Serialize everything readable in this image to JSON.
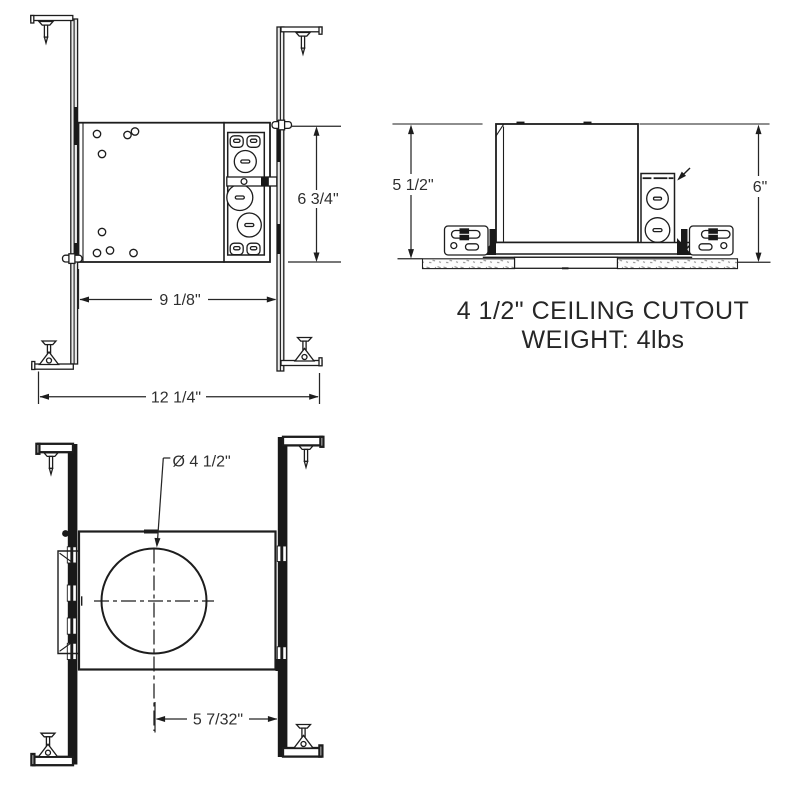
{
  "colors": {
    "ink": "#1d1d1d",
    "label_text": "#2e2e2e"
  },
  "dimensions": {
    "front_height": "6 3/4\"",
    "front_width": "9 1/8\"",
    "front_overall_width": "12 1/4\"",
    "side_height": "5 1/2\"",
    "side_overall_height": "6\"",
    "bottom_cutout_diameter": "Ø 4 1/2\"",
    "bottom_center_offset": "5 7/32\""
  },
  "caption": {
    "line1": "4 1/2\" CEILING CUTOUT",
    "line2": "WEIGHT: 4lbs"
  }
}
